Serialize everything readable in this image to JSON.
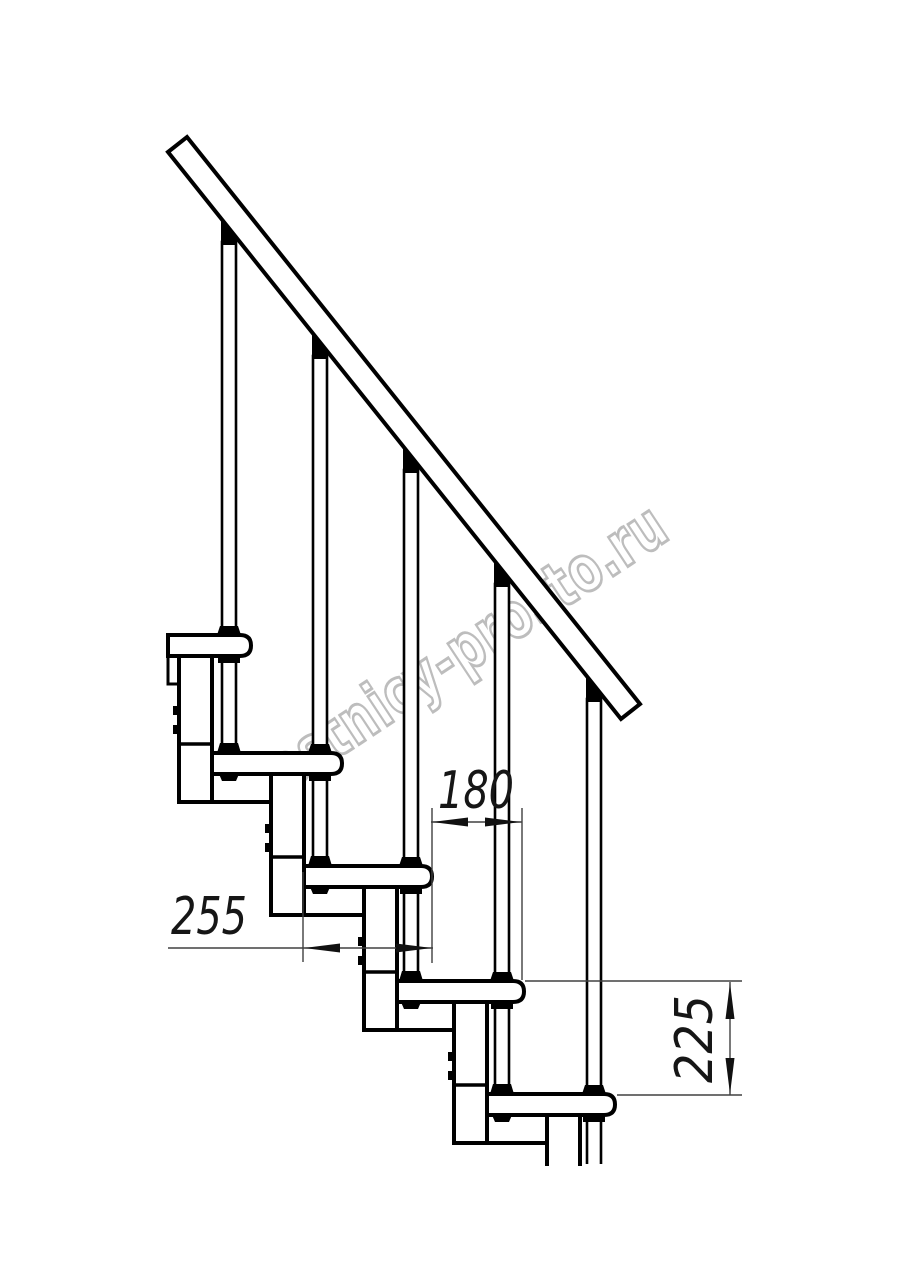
{
  "drawing": {
    "title": "modular staircase side elevation",
    "watermark": {
      "text": "lestnicy-prosto.ru",
      "color": "#bdbdbd"
    },
    "dimensions": {
      "step_run": {
        "value": "180"
      },
      "step_length": {
        "value": "255"
      },
      "step_height": {
        "value": "225"
      }
    },
    "structure": {
      "tread_count": 5,
      "baluster_count": 5
    },
    "colors": {
      "outline": "#000000",
      "background": "#ffffff",
      "dimension_line": "#404040"
    }
  }
}
